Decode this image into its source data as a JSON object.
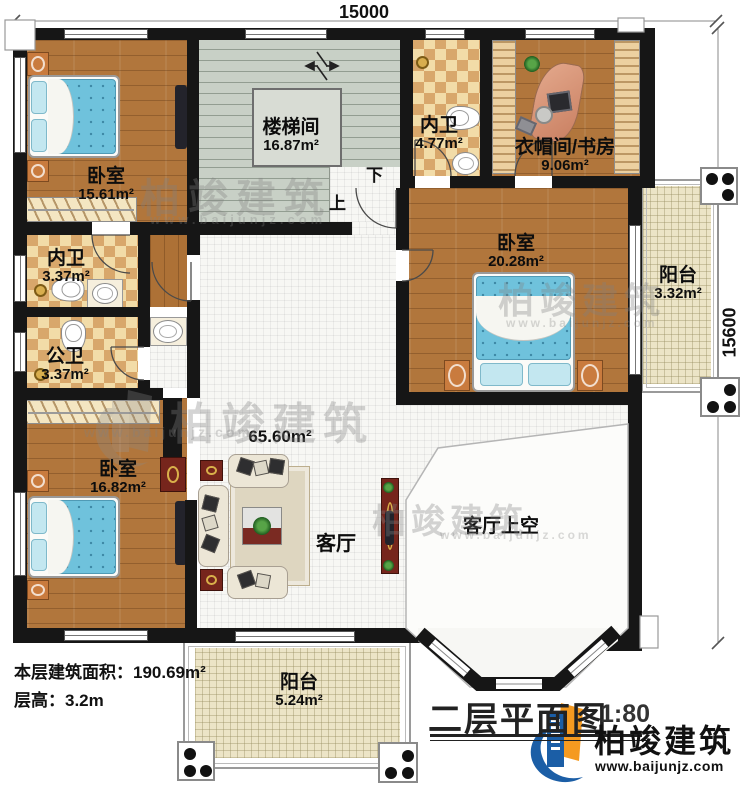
{
  "dimensions": {
    "top": "15000",
    "right": "15600"
  },
  "rooms": [
    {
      "name": "卧室",
      "area": "15.61m²"
    },
    {
      "name": "楼梯间",
      "area": "16.87m²"
    },
    {
      "name": "内卫",
      "area": "4.77m²"
    },
    {
      "name": "衣帽间/书房",
      "area": "9.06m²"
    },
    {
      "name": "卧室",
      "area": "20.28m²"
    },
    {
      "name": "阳台",
      "area": "3.32m²"
    },
    {
      "name": "内卫",
      "area": "3.37m²"
    },
    {
      "name": "公卫",
      "area": "3.37m²"
    },
    {
      "name": "卧室",
      "area": "16.82m²"
    },
    {
      "name": "客厅",
      "area": "65.60m²"
    },
    {
      "name": "客厅上空",
      "area": ""
    },
    {
      "name": "阳台",
      "area": "5.24m²"
    }
  ],
  "stairs": {
    "up": "上",
    "down": "下"
  },
  "info": {
    "line1": "本层建筑面积：190.69m²",
    "line2": "层高：3.2m"
  },
  "title": {
    "text": "二层平面图",
    "scale": "1:80"
  },
  "brand": {
    "name": "柏竣建筑",
    "url": "www.baijunjz.com"
  },
  "watermark": {
    "text": "柏竣建筑",
    "url": "www.baijunjz.com"
  },
  "colors": {
    "wall": "#161616",
    "wood": "#b1763c",
    "living_tile": "#f7f7f4",
    "balcony_tile": "#ece4c6",
    "stair": "#c8d0c6",
    "checker_light": "#f2dca8",
    "checker_dark": "#d8a76b",
    "bed": "#6fc2dc",
    "brand_blue": "#1b5ea6",
    "brand_orange": "#f59a20"
  }
}
